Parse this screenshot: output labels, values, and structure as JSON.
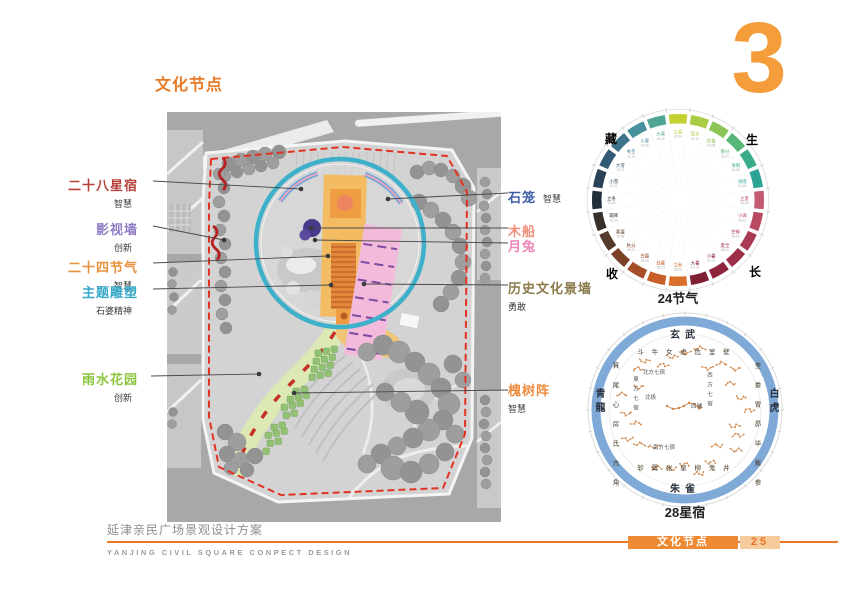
{
  "page": {
    "title": "文化节点",
    "chapter_number": "3"
  },
  "plan_labels": {
    "left": [
      {
        "name": "二十八星宿",
        "sub": "智慧",
        "color": "#b5413a"
      },
      {
        "name": "影视墙",
        "sub": "创新",
        "color": "#8f7cc5"
      },
      {
        "name": "二十四节气",
        "sub": "智慧",
        "color": "#e8923d"
      },
      {
        "name": "主题雕塑",
        "sub": "石婆精神",
        "color": "#35a8c8"
      },
      {
        "name": "雨水花园",
        "sub": "创新",
        "color": "#8cc63e"
      }
    ],
    "right": [
      {
        "name": "石笼",
        "sub": "智慧",
        "color": "#3f5fa5"
      },
      {
        "name": "木船",
        "sub": "",
        "color": "#f0907c"
      },
      {
        "name": "月兔",
        "sub": "",
        "color": "#ee86b7"
      },
      {
        "name": "历史文化景墙",
        "sub": "勇敢",
        "color": "#8a7a4a"
      },
      {
        "name": "槐树阵",
        "sub": "智慧",
        "color": "#ef8b3f"
      }
    ]
  },
  "wheel24": {
    "caption": "24节气",
    "corners": {
      "top_left": "藏",
      "top_right": "生",
      "bottom_right": "长",
      "bottom_left": "收"
    },
    "corner_colors": {
      "top_left": "#5b7f99",
      "top_right": "#d9913e",
      "bottom_right": "#9c3a3a",
      "bottom_left": "#6b6257"
    },
    "terms": [
      {
        "name": "立春",
        "date": "02.04",
        "color": "#c3d232"
      },
      {
        "name": "雨水",
        "date": "02.19",
        "color": "#aacc43"
      },
      {
        "name": "惊蛰",
        "date": "03.06",
        "color": "#8cc455"
      },
      {
        "name": "春分",
        "date": "03.21",
        "color": "#57b577"
      },
      {
        "name": "清明",
        "date": "04.05",
        "color": "#39ac8b"
      },
      {
        "name": "谷雨",
        "date": "04.20",
        "color": "#2ba496"
      },
      {
        "name": "立夏",
        "date": "05.06",
        "color": "#c65a72"
      },
      {
        "name": "小满",
        "date": "05.21",
        "color": "#b84a62"
      },
      {
        "name": "芒种",
        "date": "06.06",
        "color": "#aa3a54"
      },
      {
        "name": "夏至",
        "date": "06.21",
        "color": "#9c2e48"
      },
      {
        "name": "小暑",
        "date": "07.07",
        "color": "#8e253c"
      },
      {
        "name": "大暑",
        "date": "07.23",
        "color": "#7f1f34"
      },
      {
        "name": "立秋",
        "date": "08.08",
        "color": "#d96f2b"
      },
      {
        "name": "处暑",
        "date": "08.23",
        "color": "#c95f28"
      },
      {
        "name": "白露",
        "date": "09.08",
        "color": "#a54e28"
      },
      {
        "name": "秋分",
        "date": "09.23",
        "color": "#7c4228"
      },
      {
        "name": "寒露",
        "date": "10.08",
        "color": "#55392a"
      },
      {
        "name": "霜降",
        "date": "10.24",
        "color": "#372f28"
      },
      {
        "name": "立冬",
        "date": "11.08",
        "color": "#232e3a"
      },
      {
        "name": "小雪",
        "date": "11.22",
        "color": "#2a4258"
      },
      {
        "name": "大雪",
        "date": "12.07",
        "color": "#335a74"
      },
      {
        "name": "冬至",
        "date": "12.22",
        "color": "#3d748c"
      },
      {
        "name": "小寒",
        "date": "01.06",
        "color": "#47909e"
      },
      {
        "name": "大寒",
        "date": "01.20",
        "color": "#4fa694"
      }
    ]
  },
  "wheel28": {
    "caption": "28星宿",
    "quadrants": {
      "north": "玄武",
      "west": "白虎",
      "south": "朱雀",
      "east": "青龍"
    },
    "groups": {
      "north": "北方七宿",
      "west": "西方七宿",
      "south": "南方七宿",
      "east": "東方七宿"
    },
    "center": {
      "pole": "北极",
      "assist": "四辅"
    },
    "mansions": {
      "north": "斗 牛 女 虚 危 室 壁",
      "west": "奎 娄 胃 昴 毕 觜 参",
      "south": "轸 翼 张 星 柳 鬼 井",
      "east": "箕 尾 心 房 氐 亢 角"
    }
  },
  "footer": {
    "project_title": "延津亲民广场景观设计方案",
    "project_subtitle": "YANJING CIVIL SQUARE CONPECT DESIGN",
    "section": "文化节点",
    "page_number": "25",
    "accent_color": "#e87a25"
  }
}
